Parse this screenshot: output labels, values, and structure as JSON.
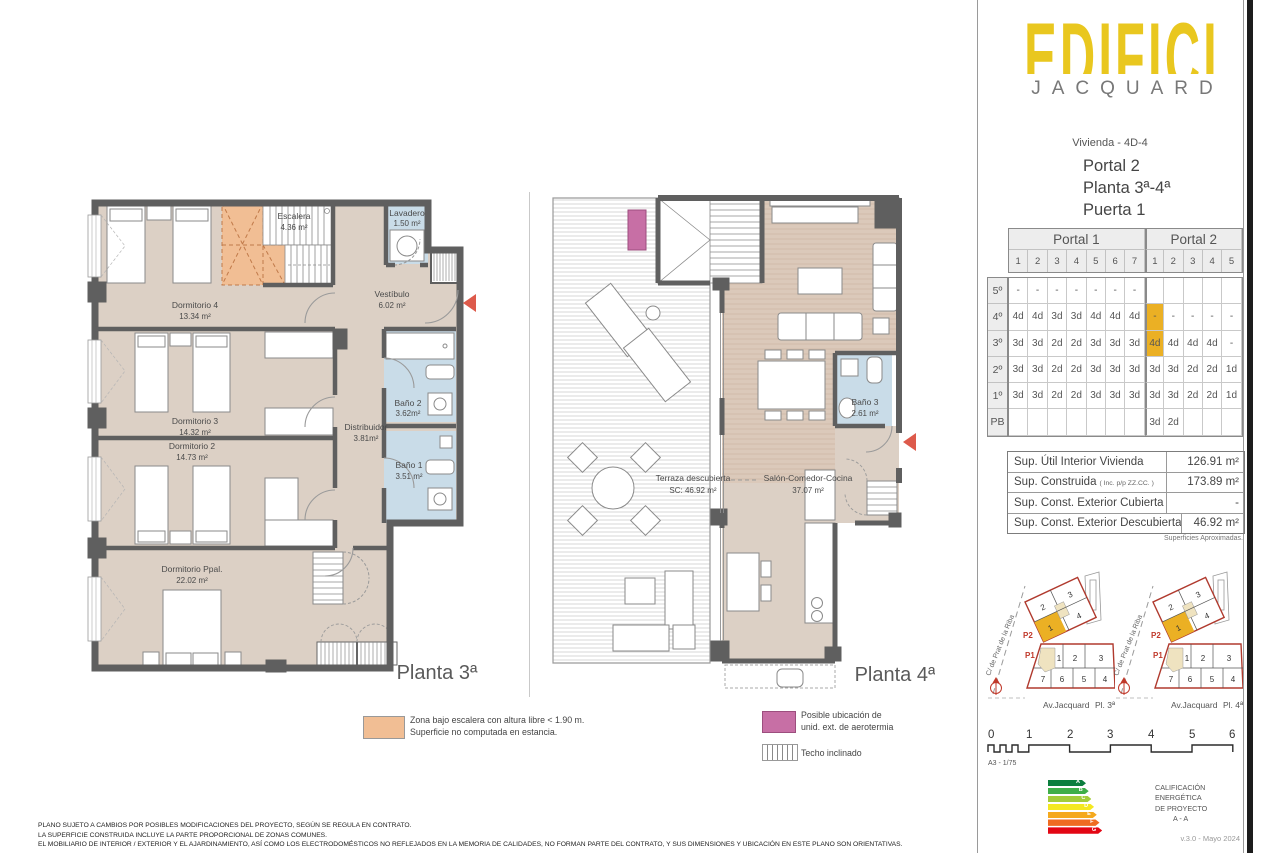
{
  "sidebar": {
    "logo": {
      "title": "EDIFICI",
      "subtitle": "JACQUARD"
    },
    "unit": {
      "vivienda": "Vivienda - 4D-4",
      "portal": "Portal  2",
      "planta": "Planta 3ª-4ª",
      "puerta": "Puerta 1"
    },
    "availability": {
      "portal1_label": "Portal 1",
      "portal2_label": "Portal 2",
      "portal1_cols": [
        "1",
        "2",
        "3",
        "4",
        "5",
        "6",
        "7"
      ],
      "portal2_cols": [
        "1",
        "2",
        "3",
        "4",
        "5"
      ],
      "floors": [
        "5º",
        "4º",
        "3º",
        "2º",
        "1º",
        "PB"
      ],
      "cells": [
        [
          "-",
          "-",
          "-",
          "-",
          "-",
          "-",
          "-",
          "",
          "",
          "",
          "",
          ""
        ],
        [
          "4d",
          "4d",
          "3d",
          "3d",
          "4d",
          "4d",
          "4d",
          "-",
          "-",
          "-",
          "-",
          "-"
        ],
        [
          "3d",
          "3d",
          "2d",
          "2d",
          "3d",
          "3d",
          "3d",
          "4d",
          "4d",
          "4d",
          "4d",
          "-"
        ],
        [
          "3d",
          "3d",
          "2d",
          "2d",
          "3d",
          "3d",
          "3d",
          "3d",
          "3d",
          "2d",
          "2d",
          "1d"
        ],
        [
          "3d",
          "3d",
          "2d",
          "2d",
          "3d",
          "3d",
          "3d",
          "3d",
          "3d",
          "2d",
          "2d",
          "1d"
        ],
        [
          "",
          "",
          "",
          "",
          "",
          "",
          "",
          "3d",
          "2d",
          "",
          "",
          ""
        ]
      ],
      "highlights": [
        [
          1,
          7
        ],
        [
          2,
          7
        ]
      ],
      "highlight_color": "#EBB024"
    },
    "surfaces": {
      "rows": [
        {
          "label": "Sup. Útil Interior Vivienda",
          "note": "",
          "value": "126.91 m²"
        },
        {
          "label": "Sup. Construida",
          "note": "( Inc. p/p ZZ.CC. )",
          "value": "173.89 m²"
        },
        {
          "label": "Sup. Const. Exterior Cubierta",
          "note": "",
          "value": "-"
        },
        {
          "label": "Sup. Const. Exterior Descubierta",
          "note": "",
          "value": "46.92 m²"
        }
      ],
      "footnote": "Superficies  Aproximadas."
    },
    "siteplans": [
      {
        "street": "C/ de Prat de la Riba",
        "p2_label": "P2",
        "p1_label": "P1",
        "p2_units": [
          "2",
          "3",
          "1",
          "4"
        ],
        "p1_top": [
          "1",
          "2",
          "3"
        ],
        "p1_bottom": [
          "7",
          "6",
          "5",
          "4"
        ],
        "caption_street": "Av.Jacquard",
        "caption_floor": "Pl. 3ª",
        "highlight_unit": "1"
      },
      {
        "street": "C/ de Prat de la Riba",
        "p2_label": "P2",
        "p1_label": "P1",
        "p2_units": [
          "2",
          "3",
          "1",
          "4"
        ],
        "p1_top": [
          "1",
          "2",
          "3"
        ],
        "p1_bottom": [
          "7",
          "6",
          "5",
          "4"
        ],
        "caption_street": "Av.Jacquard",
        "caption_floor": "Pl. 4ª",
        "highlight_unit": "1"
      }
    ],
    "scalebar": {
      "ticks": [
        "0",
        "1",
        "2",
        "3",
        "4",
        "5",
        "6"
      ],
      "label": "A3 - 1/75"
    },
    "energy": {
      "bands": [
        {
          "letter": "A",
          "color": "#0B7E3E"
        },
        {
          "letter": "B",
          "color": "#3FAE49"
        },
        {
          "letter": "C",
          "color": "#A3CC3A"
        },
        {
          "letter": "D",
          "color": "#F4E821"
        },
        {
          "letter": "E",
          "color": "#F5A91E"
        },
        {
          "letter": "F",
          "color": "#EF6B21"
        },
        {
          "letter": "G",
          "color": "#E30613"
        }
      ],
      "caption": [
        "CALIFICACIÓN",
        "ENERGÉTICA",
        "DE PROYECTO",
        "A - A"
      ]
    },
    "version": "v.3.0 - Mayo 2024"
  },
  "plans": {
    "plan3": {
      "title": "Planta 3ª",
      "rooms": [
        {
          "name": "Dormitorio 4",
          "area": "13.34 m²"
        },
        {
          "name": "Escalera",
          "area": "4.36 m²"
        },
        {
          "name": "Lavadero",
          "area": "1.50 m²"
        },
        {
          "name": "Vestíbulo",
          "area": "6.02 m²"
        },
        {
          "name": "Dormitorio 3",
          "area": "14.32 m²"
        },
        {
          "name": "Dormitorio 2",
          "area": "14.73 m²"
        },
        {
          "name": "Distribuidor",
          "area": "3.81m²"
        },
        {
          "name": "Baño 2",
          "area": "3.62m²"
        },
        {
          "name": "Baño 1",
          "area": "3.51 m²"
        },
        {
          "name": "Dormitorio Ppal.",
          "area": "22.02 m²"
        }
      ]
    },
    "plan4": {
      "title": "Planta 4ª",
      "rooms": [
        {
          "name": "Terraza descubierta",
          "area": "SC: 46.92 m²"
        },
        {
          "name": "Salón-Comedor-Cocina",
          "area": "37.07 m²"
        },
        {
          "name": "Baño 3",
          "area": "2.61 m²"
        }
      ]
    }
  },
  "legend": {
    "orange": {
      "color": "#F1BE94",
      "lines": [
        "Zona bajo escalera con altura libre < 1.90 m.",
        "Superficie no computada en estancia."
      ]
    },
    "pink": {
      "color": "#C76FA5",
      "lines": [
        "Posible ubicación de",
        "unid. ext. de aerotermia"
      ]
    },
    "striped": {
      "label": "Techo inclinado"
    }
  },
  "disclaimer": [
    "PLANO SUJETO A CAMBIOS POR POSIBLES MODIFICACIONES DEL PROYECTO, SEGÚN SE REGULA EN CONTRATO.",
    "LA SUPERFICIE CONSTRUIDA INCLUYE LA PARTE PROPORCIONAL DE ZONAS COMUNES.",
    "EL MOBILIARIO DE INTERIOR / EXTERIOR Y EL AJARDINAMIENTO, ASÍ COMO LOS ELECTRODOMÉSTICOS NO REFLEJADOS EN LA MEMORIA DE CALIDADES, NO FORMAN PARTE DEL CONTRATO, Y SUS DIMENSIONES Y UBICACIÓN EN ESTE PLANO SON ORIENTATIVAS."
  ]
}
